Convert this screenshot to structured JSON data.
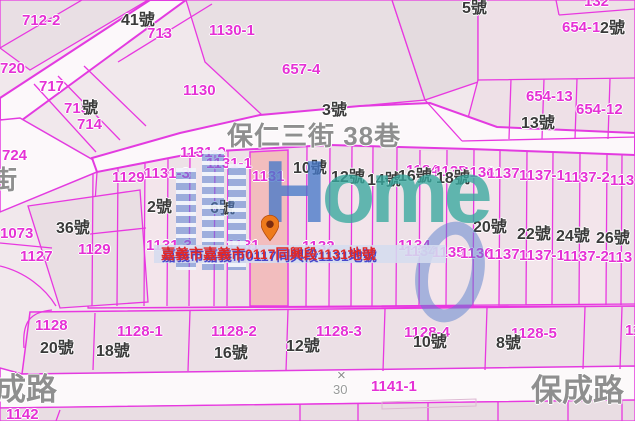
{
  "selected_parcel": {
    "caption": "嘉義市嘉義市0117同興段1131地號",
    "parcel_id": "1131"
  },
  "streets": {
    "main": "保仁三街 38巷",
    "left_partial": "街",
    "bottom_left": "成路",
    "bottom_right": "保成路"
  },
  "scale": {
    "cross": "×",
    "value": "30"
  },
  "watermark": {
    "brand_h": "H",
    "brand_rest": "ome",
    "zero": "0"
  },
  "colors": {
    "parcel_line": "#e838e0",
    "parcel_label": "#e531d5",
    "house_label": "#3a3a3a",
    "street_label": "#8f8f8f",
    "selected_fill": "#f2bdbe",
    "caption_red": "#e02828",
    "caption_shadow_blue": "#4747cc",
    "watermark_blue": "#5882d2",
    "watermark_teal": "#37a89e",
    "pin_orange": "#ee7a1c"
  },
  "labels": {
    "parcel_numbers": [
      {
        "t": "712-2",
        "x": 22,
        "y": 13
      },
      {
        "t": "713",
        "x": 147,
        "y": 26
      },
      {
        "t": "720",
        "x": 0,
        "y": 61
      },
      {
        "t": "717",
        "x": 39,
        "y": 79
      },
      {
        "t": "715",
        "x": 64,
        "y": 101
      },
      {
        "t": "714",
        "x": 77,
        "y": 117
      },
      {
        "t": "724",
        "x": 2,
        "y": 148
      },
      {
        "t": "1130-1",
        "x": 209,
        "y": 23
      },
      {
        "t": "1130",
        "x": 183,
        "y": 83
      },
      {
        "t": "657-4",
        "x": 282,
        "y": 62
      },
      {
        "t": "132",
        "x": 584,
        "y": -6
      },
      {
        "t": "654-1",
        "x": 562,
        "y": 20
      },
      {
        "t": "654-13",
        "x": 526,
        "y": 89
      },
      {
        "t": "654-12",
        "x": 576,
        "y": 102
      },
      {
        "t": "1129",
        "x": 112,
        "y": 170
      },
      {
        "t": "1131-2",
        "x": 180,
        "y": 145
      },
      {
        "t": "1131-1",
        "x": 206,
        "y": 156
      },
      {
        "t": "1131",
        "x": 252,
        "y": 169
      },
      {
        "t": "1131-3",
        "x": 144,
        "y": 166
      },
      {
        "t": "1134",
        "x": 406,
        "y": 163
      },
      {
        "t": "1135",
        "x": 434,
        "y": 164
      },
      {
        "t": "1136",
        "x": 462,
        "y": 165
      },
      {
        "t": "1137",
        "x": 487,
        "y": 166
      },
      {
        "t": "1137-1",
        "x": 519,
        "y": 168
      },
      {
        "t": "1137-2",
        "x": 564,
        "y": 170
      },
      {
        "t": "113",
        "x": 610,
        "y": 173
      },
      {
        "t": "1073",
        "x": 0,
        "y": 226
      },
      {
        "t": "1127",
        "x": 20,
        "y": 249
      },
      {
        "t": "1129",
        "x": 78,
        "y": 242
      },
      {
        "t": "1131-3",
        "x": 146,
        "y": 238
      },
      {
        "t": "1131",
        "x": 227,
        "y": 238
      },
      {
        "t": "1132",
        "x": 302,
        "y": 239
      },
      {
        "t": "1134",
        "x": 398,
        "y": 238
      },
      {
        "t": "1134",
        "x": 404,
        "y": 244
      },
      {
        "t": "1135",
        "x": 432,
        "y": 245
      },
      {
        "t": "1136",
        "x": 460,
        "y": 246
      },
      {
        "t": "1137",
        "x": 487,
        "y": 247
      },
      {
        "t": "1137-1",
        "x": 519,
        "y": 248
      },
      {
        "t": "1137-2",
        "x": 563,
        "y": 249
      },
      {
        "t": "113",
        "x": 608,
        "y": 250
      },
      {
        "t": "1128",
        "x": 35,
        "y": 318
      },
      {
        "t": "1128-1",
        "x": 117,
        "y": 324
      },
      {
        "t": "1128-2",
        "x": 211,
        "y": 324
      },
      {
        "t": "1128-3",
        "x": 316,
        "y": 324
      },
      {
        "t": "1128-4",
        "x": 404,
        "y": 325
      },
      {
        "t": "1128-5",
        "x": 511,
        "y": 326
      },
      {
        "t": "11",
        "x": 625,
        "y": 323
      },
      {
        "t": "1141-1",
        "x": 371,
        "y": 379
      },
      {
        "t": "1142",
        "x": 6,
        "y": 407
      }
    ],
    "house_numbers": [
      {
        "t": "41號",
        "x": 121,
        "y": 13
      },
      {
        "t": "5號",
        "x": 462,
        "y": 1
      },
      {
        "t": "2號",
        "x": 600,
        "y": 21
      },
      {
        "t": "3號",
        "x": 322,
        "y": 103
      },
      {
        "t": "13號",
        "x": 521,
        "y": 116
      },
      {
        "t": "號",
        "x": 82,
        "y": 101
      },
      {
        "t": "10號",
        "x": 293,
        "y": 161
      },
      {
        "t": "12號",
        "x": 331,
        "y": 170
      },
      {
        "t": "14號",
        "x": 367,
        "y": 173
      },
      {
        "t": "16號",
        "x": 398,
        "y": 169
      },
      {
        "t": "18號",
        "x": 436,
        "y": 171
      },
      {
        "t": "2號",
        "x": 147,
        "y": 200
      },
      {
        "t": "6號",
        "x": 210,
        "y": 201
      },
      {
        "t": "36號",
        "x": 56,
        "y": 221
      },
      {
        "t": "20號",
        "x": 473,
        "y": 220
      },
      {
        "t": "22號",
        "x": 517,
        "y": 227
      },
      {
        "t": "24號",
        "x": 556,
        "y": 229
      },
      {
        "t": "26號",
        "x": 596,
        "y": 231
      },
      {
        "t": "20號",
        "x": 40,
        "y": 341
      },
      {
        "t": "18號",
        "x": 96,
        "y": 344
      },
      {
        "t": "16號",
        "x": 214,
        "y": 346
      },
      {
        "t": "12號",
        "x": 286,
        "y": 339
      },
      {
        "t": "10號",
        "x": 413,
        "y": 335
      },
      {
        "t": "8號",
        "x": 496,
        "y": 336
      }
    ]
  }
}
